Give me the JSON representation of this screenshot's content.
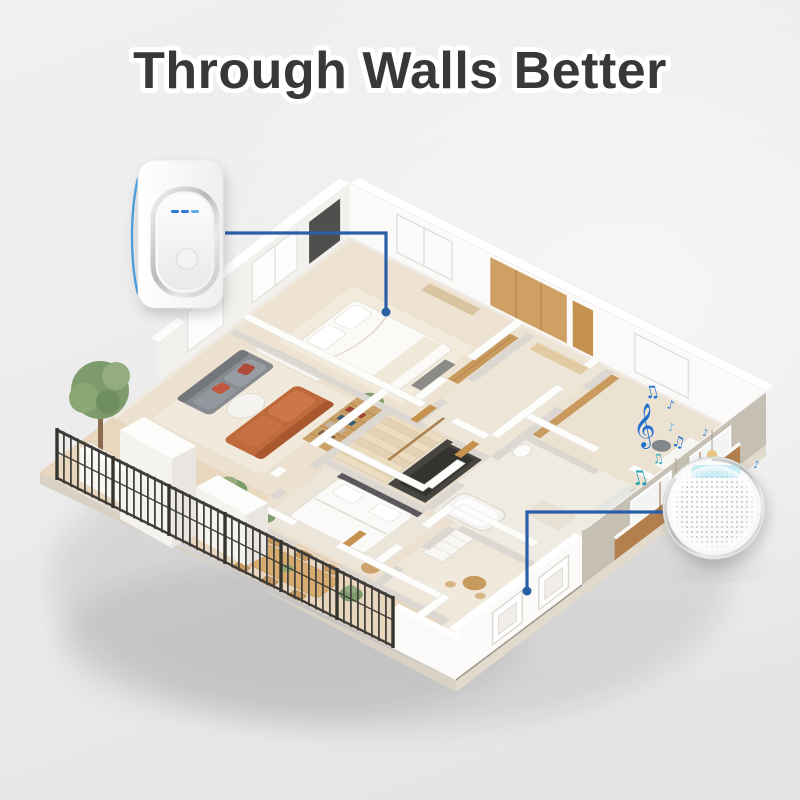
{
  "title": "Through Walls Better",
  "devices": {
    "transmitter": {
      "name": "doorbell push button",
      "led_count": 3,
      "led_color": "#2e7ad6",
      "accent_color": "#3b96dc"
    },
    "receiver": {
      "name": "doorbell chime speaker",
      "glow_color": "#a5e3f0",
      "dot_color": "#c4c4c4"
    }
  },
  "signal": {
    "color": "#2a5fa8",
    "endpoint_style": "dot"
  },
  "music_notes": [
    {
      "glyph": "♫"
    },
    {
      "glyph": "♪"
    },
    {
      "glyph": "𝄞"
    },
    {
      "glyph": "♪"
    },
    {
      "glyph": "♫"
    },
    {
      "glyph": "♪"
    },
    {
      "glyph": "♫"
    },
    {
      "glyph": "♫"
    },
    {
      "glyph": "♪"
    }
  ],
  "colors": {
    "title": "#383838",
    "title_outline": "#ffffff",
    "signal_blue": "#2a5fa8",
    "note_blue": "#1f6fd0",
    "note_teal": "#2aa6b8",
    "wall_white": "#ffffff",
    "mirror_wall_gray": "#c6bfb4",
    "floor_beige": "#ece2d2",
    "terrace_tan": "#e8d6bf",
    "wood": "#c89a5e",
    "sofa_gray": "#878a8f",
    "sofa_orange": "#bf6a3b",
    "fence_dark": "#44433f",
    "background": "#ececec"
  }
}
